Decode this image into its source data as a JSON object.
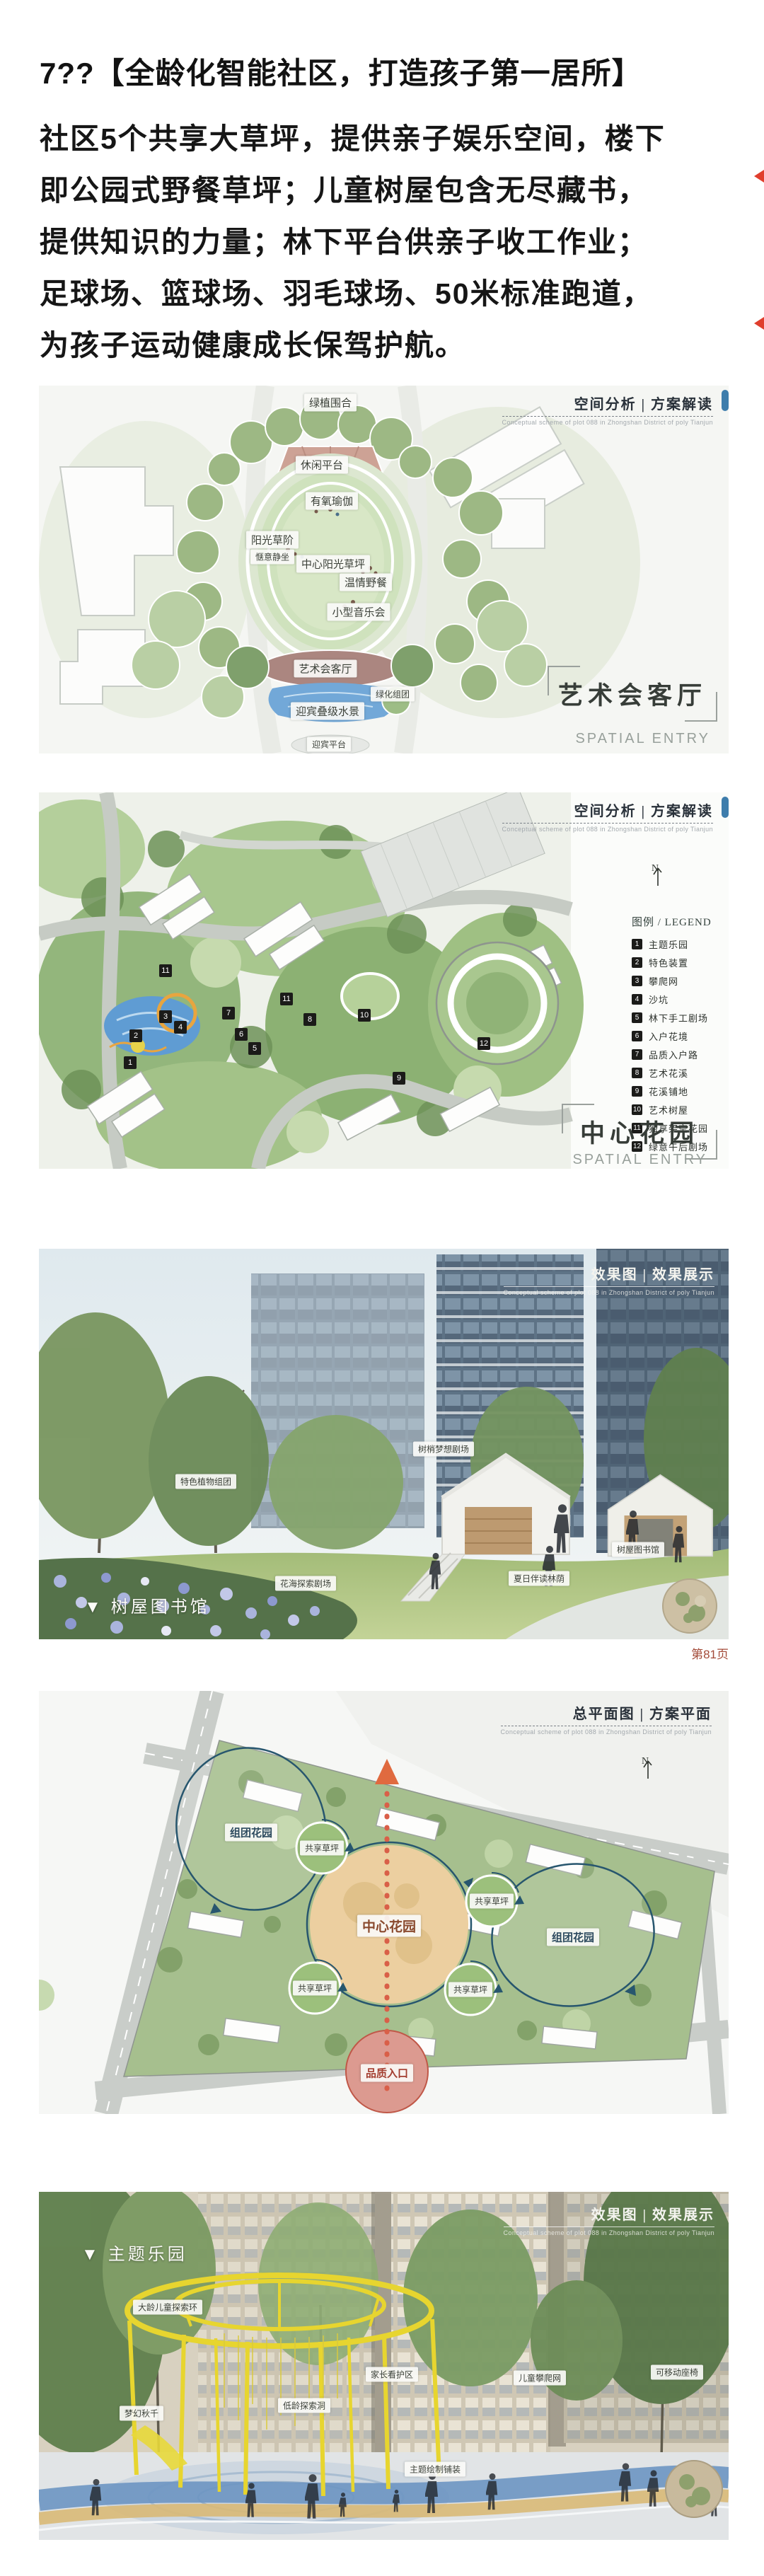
{
  "page": {
    "title": "7??【全龄化智能社区，打造孩子第一居所】",
    "paragraph_lines": [
      "社区5个共享大草坪，提供亲子娱乐空间，楼下",
      "即公园式野餐草坪；儿童树屋包含无尽藏书，",
      "提供知识的力量；林下平台供亲子收工作业；",
      "足球场、篮球场、羽毛球场、50米标准跑道，",
      "为孩子运动健康成长保驾护航。"
    ],
    "page_number": "第81页"
  },
  "common": {
    "header_en": "Conceptual scheme of plot 088 in Zhongshan District of poly Tianjun",
    "spatial_entry": "SPATIAL ENTRY",
    "compass_n": "N"
  },
  "fig1": {
    "header_title": "空间分析 | 方案解读",
    "labels": {
      "enclosure": "绿植围合",
      "leisure": "休闲平台",
      "yoga": "有氧瑜伽",
      "steps": "阳光草阶",
      "sit": "惬意静坐",
      "lawn": "中心阳光草坪",
      "picnic": "温情野餐",
      "concert": "小型音乐会",
      "artroom": "艺术会客厅",
      "cluster": "绿化组团",
      "water": "迎宾叠级水景",
      "platform": "迎宾平台"
    },
    "caption": "艺术会客厅"
  },
  "fig2": {
    "header_title": "空间分析 | 方案解读",
    "legend_title": "图例 / LEGEND",
    "legend": [
      {
        "n": "1",
        "label": "主题乐园"
      },
      {
        "n": "2",
        "label": "特色装置"
      },
      {
        "n": "3",
        "label": "攀爬网"
      },
      {
        "n": "4",
        "label": "沙坑"
      },
      {
        "n": "5",
        "label": "林下手工剧场"
      },
      {
        "n": "6",
        "label": "入户花境"
      },
      {
        "n": "7",
        "label": "品质入户路"
      },
      {
        "n": "8",
        "label": "艺术花溪"
      },
      {
        "n": "9",
        "label": "花溪铺地"
      },
      {
        "n": "10",
        "label": "艺术树屋"
      },
      {
        "n": "11",
        "label": "独享架空花园"
      },
      {
        "n": "12",
        "label": "绿意午后剧场"
      }
    ],
    "markers": [
      "11",
      "11",
      "7",
      "8",
      "10",
      "6",
      "5",
      "3",
      "4",
      "2",
      "1",
      "9",
      "12"
    ],
    "caption": "中心花园"
  },
  "fig3": {
    "header_title": "效果图 | 效果展示",
    "labels": {
      "plants": "特色植物组团",
      "treetop": "树梢梦想剧场",
      "treehouse": "树屋图书馆",
      "shade": "夏日伴读林荫",
      "flower": "花海探索剧场"
    },
    "caption": "▼ 树屋图书馆"
  },
  "fig4": {
    "header_title": "总平面图 | 方案平面",
    "labels": {
      "cluster": "组团花园",
      "lawn": "共享草坪",
      "center": "中心花园",
      "entry": "品质入口"
    }
  },
  "fig5": {
    "header_title": "效果图 | 效果展示",
    "labels": {
      "ring": "大龄儿童探索环",
      "guard": "家长看护区",
      "climb": "儿童攀爬网",
      "seat": "可移动座椅",
      "swing": "梦幻秋千",
      "cave": "低龄探索洞",
      "paving": "主题绘制铺装"
    },
    "caption": "▼ 主题乐园"
  },
  "colors": {
    "accent_red": "#d95f48",
    "water_blue": "#5f9cd3",
    "lawn_green": "#a9c78f",
    "legend_black": "#1b1b19",
    "caption_gray": "#98a09b"
  }
}
